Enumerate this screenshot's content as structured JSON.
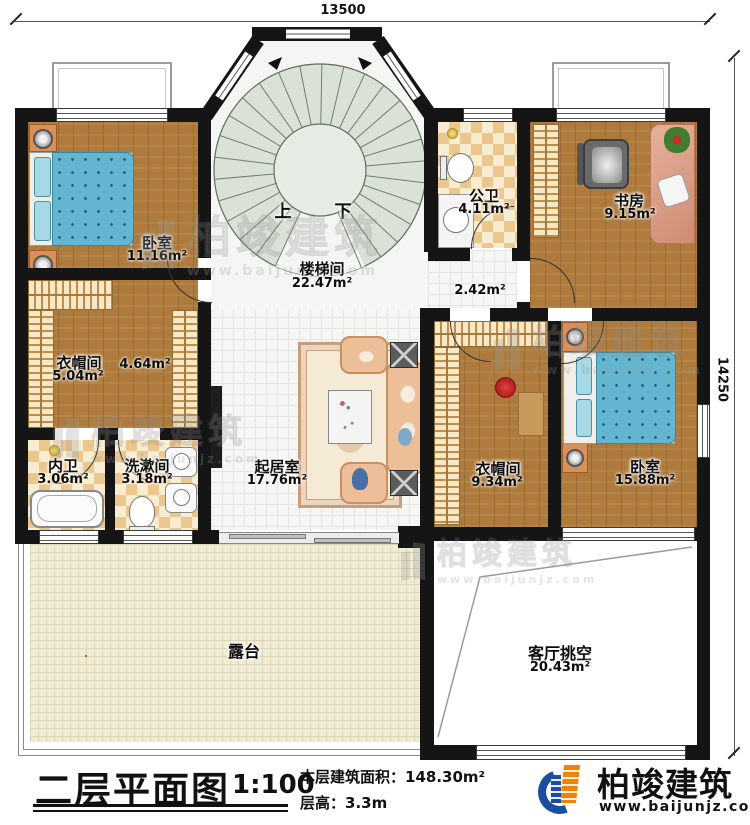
{
  "dims": {
    "top": "13500",
    "right": "14250"
  },
  "stair": {
    "name": "楼梯间",
    "area": "22.47m²",
    "up": "上",
    "down": "下"
  },
  "rooms": {
    "bedroom1": {
      "name": "卧室",
      "area": "11.16m²"
    },
    "cloakroom1": {
      "name": "衣帽间",
      "area": "5.04m²"
    },
    "corridor": {
      "area": "4.64m²"
    },
    "ensuite": {
      "name": "内卫",
      "area": "3.06m²"
    },
    "washroom": {
      "name": "洗漱间",
      "area": "3.18m²"
    },
    "living": {
      "name": "起居室",
      "area": "17.76m²"
    },
    "publicbath": {
      "name": "公卫",
      "area": "4.11m²"
    },
    "hall": {
      "area": "2.42m²"
    },
    "study": {
      "name": "书房",
      "area": "9.15m²"
    },
    "cloakroom2": {
      "name": "衣帽间",
      "area": "9.34m²"
    },
    "bedroom2": {
      "name": "卧室",
      "area": "15.88m²"
    },
    "terrace": {
      "name": "露台"
    },
    "void": {
      "name": "客厅挑空",
      "area": "20.43m²"
    }
  },
  "title": {
    "title": "二层平面图",
    "scale": "1:100",
    "area_label": "本层建筑面积：",
    "area_value": "148.30m²",
    "height_label": "层高：",
    "height_value": "3.3m"
  },
  "brand": {
    "name": "柏竣建筑",
    "url": "www.baijunjz.com"
  },
  "wm": {
    "name": "柏竣建筑",
    "url": "www.baijunjz.com"
  },
  "colors": {
    "wall": "#151515",
    "wood": "#ae7b3c",
    "bed_blue": "#64b6d0",
    "brand_blue": "#1b4e9e",
    "brand_orange": "#f08300"
  }
}
